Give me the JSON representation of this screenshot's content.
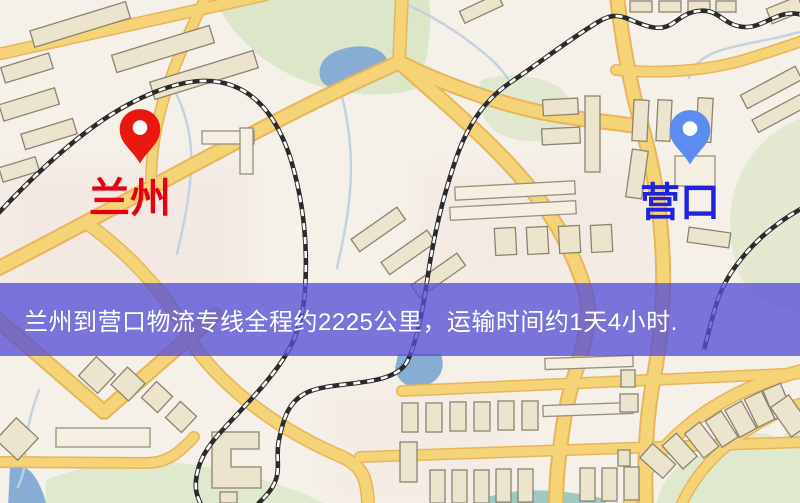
{
  "banner": {
    "text": "兰州到营口物流专线全程约2225公里，运输时间约1天4小时."
  },
  "markers": {
    "origin": {
      "label": "兰州"
    },
    "destination": {
      "label": "营口"
    }
  },
  "colors": {
    "background": "#f5f0e8",
    "road": "#f5d377",
    "road_casing": "#e7b55a",
    "railway": "#2b2b2b",
    "building": "#ece4cc",
    "park": "#dbe7c8",
    "water": "#87add5",
    "origin_pin": "#ea1710",
    "origin_label": "#e60012",
    "destination_pin": "#5b8df0",
    "destination_label": "#2222dd",
    "banner_bg": "rgba(86,80,214,0.78)",
    "banner_text": "#ffffff"
  }
}
